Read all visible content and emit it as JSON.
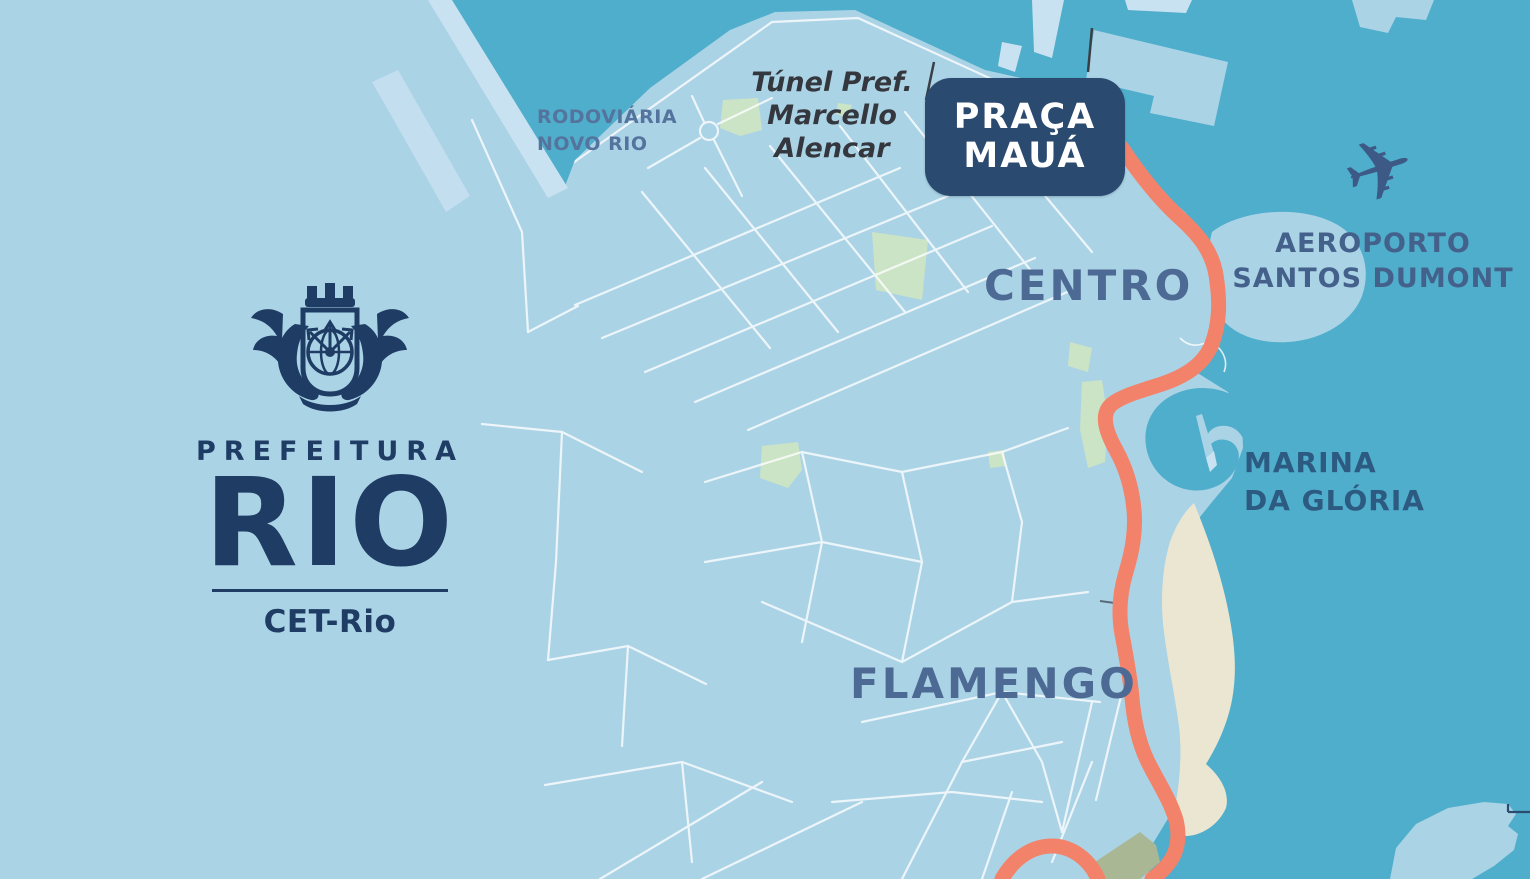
{
  "logo": {
    "prefeitura": "PREFEITURA",
    "rio": "RIO",
    "division": "CET-Rio"
  },
  "badge": {
    "line1": "PRAÇA",
    "line2": "MAUÁ"
  },
  "labels": {
    "rodoviaria": {
      "line1": "RODOVIÁRIA",
      "line2": "NOVO RIO"
    },
    "tunel": {
      "line1": "Túnel Pref.",
      "line2": "Marcello",
      "line3": "Alencar"
    },
    "centro": "CENTRO",
    "aeroporto": {
      "line1": "AEROPORTO",
      "line2": "SANTOS DUMONT"
    },
    "marina": {
      "line1": "MARINA",
      "line2": "DA GLÓRIA"
    },
    "flamengo": "FLAMENGO"
  },
  "icons": {
    "airplane": "✈"
  },
  "colors": {
    "water": "#4FAECB",
    "land": "#ABD3E6",
    "land_pale": "#C9E2F1",
    "route_orange": "#F2836A",
    "navy_logo": "#1E3C64",
    "badge_bg": "#2B4A70",
    "badge_text": "#FFFFFF",
    "park_green": "#CBE4C6",
    "olive_green": "#A9B795",
    "beach_sand": "#EBE6D2",
    "road_white": "#FFFFFF",
    "district_label": "#4C6A93",
    "airport_label": "#44618C",
    "marina_label": "#2D5A81",
    "rodoviaria_label": "#54749E",
    "tunnel_label": "#34383E",
    "airplane_icon": "#3D5A87"
  }
}
